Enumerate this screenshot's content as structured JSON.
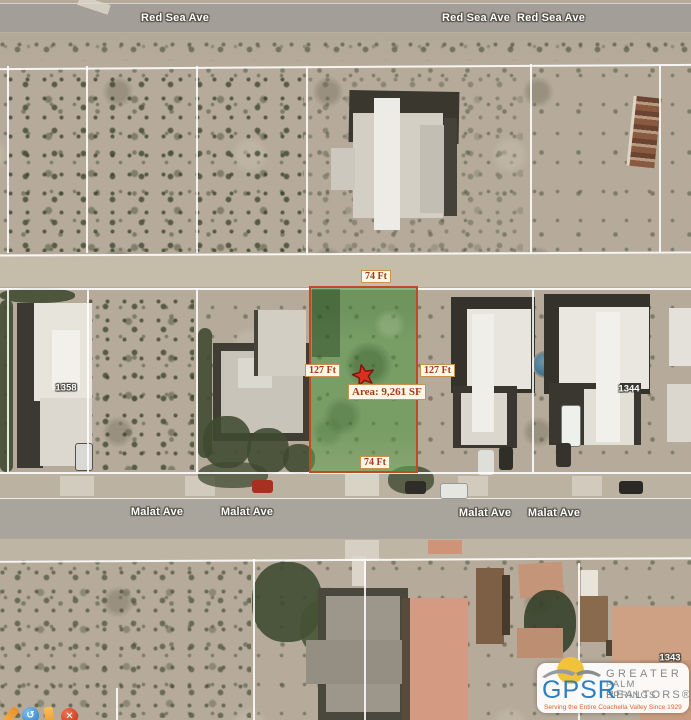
{
  "streets": {
    "red_sea_ave": "Red Sea Ave",
    "malat_ave": "Malat Ave"
  },
  "parcel": {
    "frontage": "74 Ft",
    "depth": "127 Ft",
    "area": "Area: 9,261 SF",
    "fill_color": "#3f8f35",
    "border_color": "#c04a28",
    "star_color": "#d93020"
  },
  "lot_numbers": {
    "left": "1358",
    "right": "1344",
    "bottom": "1343"
  },
  "labels_style": {
    "bg": "#fdf7e6",
    "text": "#a8391f"
  },
  "logo": {
    "acronym": "GPSR",
    "line1": "GREATER",
    "line2": "PALM SPRINGS",
    "line3": "REALTORS®",
    "tagline": "Serving the Entire Coachella Valley Since 1929",
    "blue": "#2e7fc0",
    "gray": "#85898c",
    "tagline_color": "#e0622e",
    "sun_color": "#f2c338"
  },
  "toolbar": {
    "icons": [
      "pencil-icon",
      "rotate-icon",
      "marker-icon",
      "delete-icon"
    ],
    "rotate_glyph": "↺",
    "delete_glyph": "✕"
  }
}
